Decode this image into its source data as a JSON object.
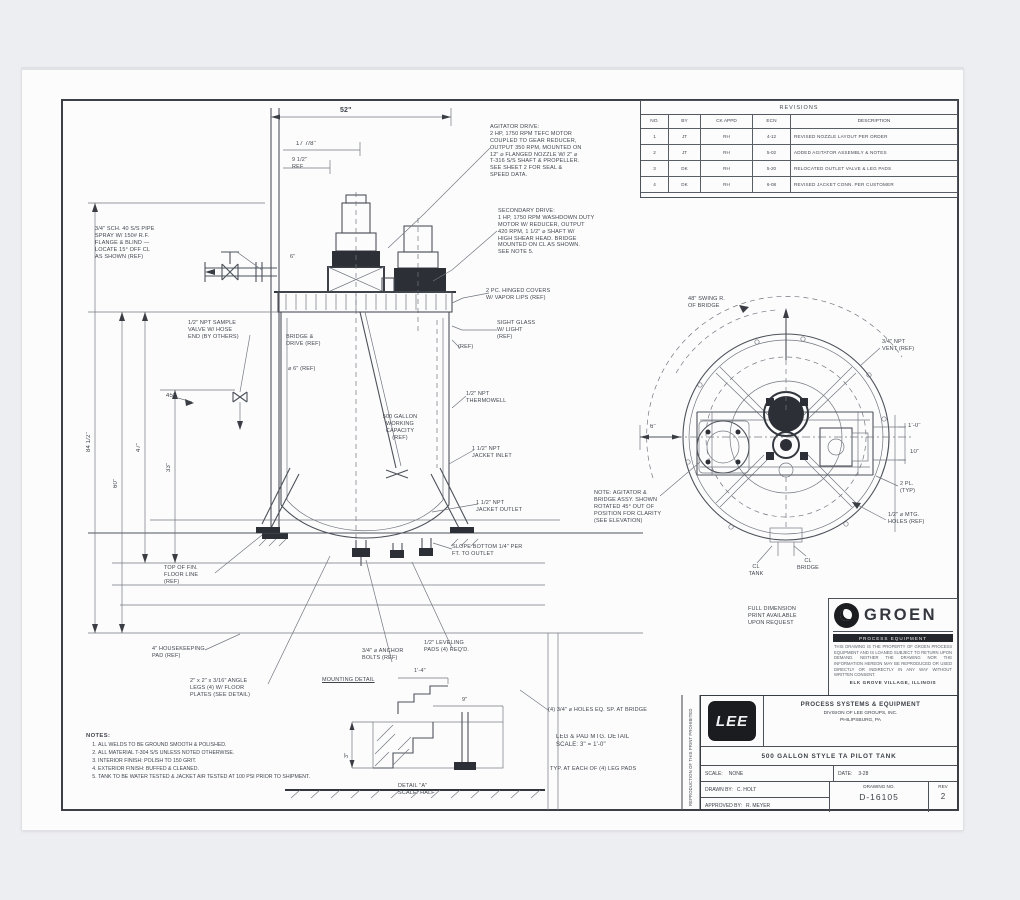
{
  "colors": {
    "page_background": "#edeef2",
    "sheet": "#fcfcfd",
    "ink": "#4d525a",
    "dark_fill": "#2c3036"
  },
  "brand_block": {
    "brand": "GROEN",
    "tagline": "PROCESS EQUIPMENT",
    "notice": "THIS DRAWING IS THE PROPERTY OF GROEN PROCESS EQUIPMENT AND IS LOANED SUBJECT TO RETURN UPON DEMAND. NEITHER THE DRAWING NOR THE INFORMATION HEREON MAY BE REPRODUCED OR USED DIRECTLY OR INDIRECTLY IN ANY WAY WITHOUT WRITTEN CONSENT.",
    "footer": "ELK GROVE VILLAGE, ILLINOIS"
  },
  "title_block": {
    "logo": "LEE",
    "company": "PROCESS SYSTEMS & EQUIPMENT",
    "division": "DIVISION OF LEE GROUPS, INC.",
    "city": "PHILIPSBURG, PA",
    "title": "500 GALLON STYLE TA PILOT TANK",
    "scale_label": "SCALE:",
    "scale_value": "NONE",
    "date_label": "DATE:",
    "date_value": "3-28",
    "drawn_label": "DRAWN BY:",
    "drawn_value": "C. HOLT",
    "approved_label": "APPROVED BY:",
    "approved_value": "R. MEYER",
    "dwg_label": "DRAWING NO.",
    "dwg_value": "D-16105",
    "rev_label": "REV",
    "rev_value": "2"
  },
  "revision_table": {
    "title": "REVISIONS",
    "headers": [
      "NO.",
      "BY",
      "CK  APPD",
      "ECN",
      "DESCRIPTION"
    ],
    "rows": [
      [
        "1",
        "JT",
        "RH",
        "4-12",
        "REVISED NOZZLE LAYOUT PER ORDER"
      ],
      [
        "2",
        "JT",
        "RH",
        "5-02",
        "ADDED AGITATOR ASSEMBLY & NOTES"
      ],
      [
        "3",
        "DK",
        "RH",
        "5-20",
        "RELOCATED OUTLET VALVE & LEG PADS"
      ],
      [
        "4",
        "DK",
        "RH",
        "6-08",
        "REVISED JACKET CONN. PER CUSTOMER"
      ]
    ]
  },
  "notes": {
    "heading": "NOTES:",
    "items": [
      "ALL WELDS TO BE GROUND SMOOTH & POLISHED.",
      "ALL MATERIAL T-304 S/S UNLESS NOTED OTHERWISE.",
      "INTERIOR FINISH: POLISH TO 150 GRIT.",
      "EXTERIOR FINISH: BUFFED & CLEANED.",
      "TANK TO BE WATER TESTED & JACKET AIR TESTED AT 100 PSI PRIOR TO SHIPMENT."
    ]
  },
  "labels": {
    "dim_w": "52\"",
    "dim_a": "17 7/8\"",
    "dim_b": "9 1/2\"\nREF",
    "dim_pipe": "6\"",
    "note_pipe": "3/4\" SCH. 40 S/S PIPE\nSPRAY W/ 150# R.F.\nFLANGE & BLIND —\nLOCATE 15° OFF CL\nAS SHOWN (REF)",
    "note_valve": "1/2\" NPT SAMPLE\nVALVE W/ HOSE\nEND (BY OTHERS)",
    "dim_45": "45°",
    "dim_h1": "84 1/2\"",
    "dim_h2": "60\"",
    "dim_h3": "47\"",
    "dim_h4": "33\"",
    "note_agit1": "AGITATOR DRIVE:\n2 HP, 1750 RPM TEFC MOTOR\nCOUPLED TO GEAR REDUCER,\nOUTPUT 350 RPM, MOUNTED ON\n12\" ⌀ FLANGED NOZZLE W/ 2\" ⌀\nT-316 S/S SHAFT & PROPELLER.\nSEE SHEET 2 FOR SEAL &\nSPEED DATA.",
    "note_agit2": "SECONDARY DRIVE:\n1 HP, 1750 RPM WASHDOWN DUTY\nMOTOR W/ REDUCER, OUTPUT\n420 RPM, 1 1/2\" ⌀ SHAFT W/\nHIGH SHEAR HEAD. BRIDGE\nMOUNTED ON CL AS SHOWN.\nSEE NOTE 5.",
    "note_cover": "2 PC. HINGED COVERS\nW/ VAPOR LIPS (REF)",
    "lbl_bridge": "BRIDGE &\nDRIVE (REF)",
    "lbl_vortex": "⌀ 6\" (REF)",
    "r_sight": "SIGHT GLASS\nW/ LIGHT\n(REF)",
    "r_ref": "(REF)",
    "r_thermo": "1/2\" NPT\nTHERMOWELL",
    "r_jin": "1 1/2\" NPT\nJACKET INLET",
    "r_jout": "1 1/2\" NPT\nJACKET OUTLET",
    "r_slope": "SLOPE BOTTOM 1/4\" PER\nFT. TO OUTLET",
    "intank": "500 GALLON\nWORKING\nCAPACITY\n(REF)",
    "b_floor": "TOP OF FIN.\nFLOOR LINE\n(REF)",
    "b_pad": "4\" HOUSEKEEPING\nPAD (REF)",
    "b_leg": "2\" x 2\" x 3/16\" ANGLE\nLEGS (4) W/ FLOOR\nPLATES (SEE DETAIL)",
    "b_mount": "MOUNTING DETAIL",
    "b_anchor": "3/4\" ⌀ ANCHOR\nBOLTS (REF)",
    "b_lvl": "1/2\" LEVELING\nPADS (4) REQ'D.",
    "d_holes": "(4) 3/4\" ⌀ HOLES EQ. SP. AT BRIDGE",
    "d_title": "LEG & PAD MTG. DETAIL\nSCALE: 3\" = 1'-0\"",
    "d_typ": "TYP. AT EACH OF (4) LEG PADS",
    "d_secA": "DETAIL \"A\"\nSCALE: HALF",
    "d_dim1": "3\"",
    "d_dim2": "9\"",
    "d_dim3": "1'-4\"",
    "p_note": "NOTE: AGITATOR &\nBRIDGE ASSY. SHOWN\nROTATED 45° OUT OF\nPOSITION FOR CLARITY\n(SEE ELEVATION)",
    "p_cl": "CL\nTANK",
    "p_clb": "CL\nBRIDGE",
    "p_dim_l": "6\"",
    "p_r1": "1'-0\"",
    "p_r2": "10\"",
    "p_2pl": "2 PL.\n(TYP)",
    "p_bolt": "1/2\" ⌀ MTG.\nHOLES (REF)",
    "p_vent": "3/4\" NPT\nVENT (REF)",
    "p_full": "FULL DIMENSION\nPRINT AVAILABLE\nUPON REQUEST",
    "p_swing": "48\" SWING R.\nOF BRIDGE",
    "v_strip": "REPRODUCTION OF THIS PRINT PROHIBITED"
  }
}
